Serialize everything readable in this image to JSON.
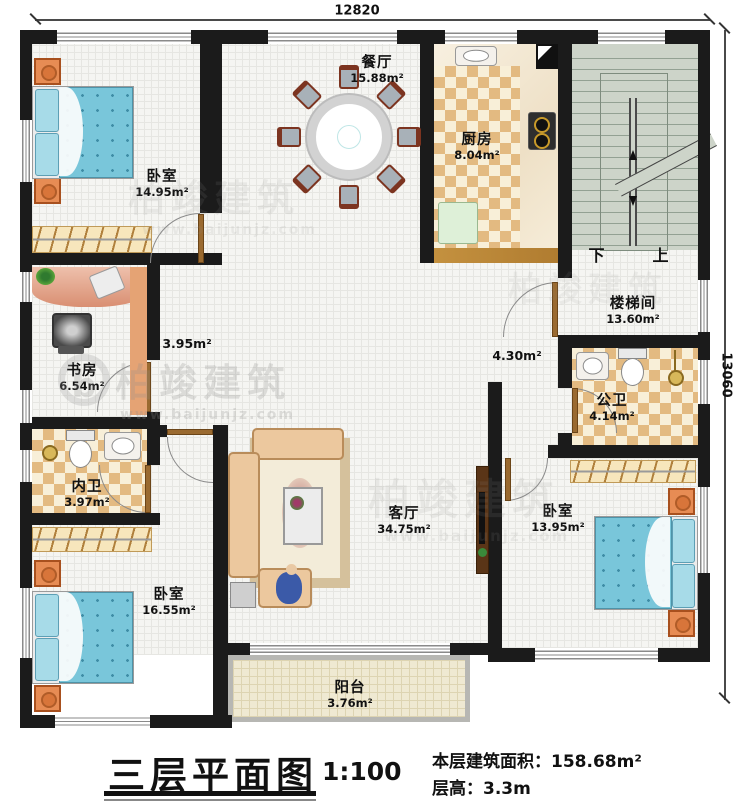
{
  "dimensions": {
    "top": "12820",
    "right": "13060"
  },
  "title_block": {
    "title": "三层平面图",
    "scale": "1:100",
    "area": "本层建筑面积：158.68m²",
    "floor_height": "层高：3.3m"
  },
  "watermark": {
    "brand": "柏竣建筑",
    "site": "www.baijunjz.com",
    "logo_letter": "b"
  },
  "stairs": {
    "down": "下",
    "up": "上"
  },
  "rooms": {
    "bedroom_nw": {
      "name": "卧室",
      "area": "14.95m²"
    },
    "dining": {
      "name": "餐厅",
      "area": "15.88m²"
    },
    "kitchen": {
      "name": "厨房",
      "area": "8.04m²"
    },
    "stairwell": {
      "name": "楼梯间",
      "area": "13.60m²"
    },
    "study": {
      "name": "书房",
      "area": "6.54m²"
    },
    "bath_inner": {
      "name": "内卫",
      "area": "3.97m²"
    },
    "bath_public": {
      "name": "公卫",
      "area": "4.14m²"
    },
    "bedroom_sw": {
      "name": "卧室",
      "area": "16.55m²"
    },
    "bedroom_se": {
      "name": "卧室",
      "area": "13.95m²"
    },
    "living": {
      "name": "客厅",
      "area": "34.75m²"
    },
    "balcony": {
      "name": "阳台",
      "area": "3.76m²"
    },
    "hall_left": {
      "area": "3.95m²"
    },
    "hall_right": {
      "area": "4.30m²"
    }
  }
}
